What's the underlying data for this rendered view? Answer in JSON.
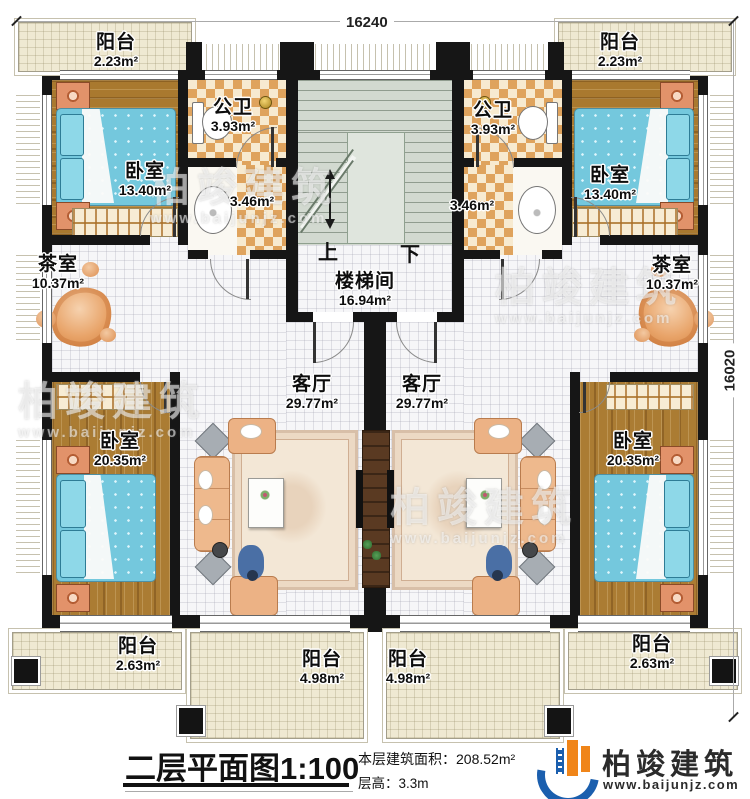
{
  "dimensions": {
    "top": "16240",
    "right": "16020"
  },
  "stairwell": {
    "up": "上",
    "down": "下"
  },
  "rooms": {
    "balcony_tl": {
      "name": "阳台",
      "area": "2.23m²"
    },
    "balcony_tr": {
      "name": "阳台",
      "area": "2.23m²"
    },
    "bath_l": {
      "name": "公卫",
      "area": "3.93m²"
    },
    "bath_r": {
      "name": "公卫",
      "area": "3.93m²"
    },
    "wash_l": {
      "area": "3.46m²"
    },
    "wash_r": {
      "area": "3.46m²"
    },
    "bedroom_tl": {
      "name": "卧室",
      "area": "13.40m²"
    },
    "bedroom_tr": {
      "name": "卧室",
      "area": "13.40m²"
    },
    "tea_l": {
      "name": "茶室",
      "area": "10.37m²"
    },
    "tea_r": {
      "name": "茶室",
      "area": "10.37m²"
    },
    "stair_hall": {
      "name": "楼梯间",
      "area": "16.94m²"
    },
    "living_l": {
      "name": "客厅",
      "area": "29.77m²"
    },
    "living_r": {
      "name": "客厅",
      "area": "29.77m²"
    },
    "bedroom_bl": {
      "name": "卧室",
      "area": "20.35m²"
    },
    "bedroom_br": {
      "name": "卧室",
      "area": "20.35m²"
    },
    "balcony_bl": {
      "name": "阳台",
      "area": "2.63m²"
    },
    "balcony_bcl": {
      "name": "阳台",
      "area": "4.98m²"
    },
    "balcony_bcr": {
      "name": "阳台",
      "area": "4.98m²"
    },
    "balcony_br": {
      "name": "阳台",
      "area": "2.63m²"
    }
  },
  "footer": {
    "title": "二层平面图",
    "scale": "1:100",
    "building_area": "本层建筑面积：208.52m²",
    "floor_height": "层高：3.3m"
  },
  "brand": {
    "name": "柏竣建筑",
    "website": "www.baijunjz.com"
  },
  "watermark": {
    "name": "柏竣建筑",
    "website": "www.baijunjz.com"
  },
  "colors": {
    "wall": "#161616",
    "wood": "#a9792f",
    "checker": "#dfa35d",
    "bed": "#74c8dd",
    "stair": "#d2d9d0",
    "balcony_floor": "#efe9d2",
    "brand_blue": "#1b5fae",
    "brand_orange": "#f08519"
  }
}
